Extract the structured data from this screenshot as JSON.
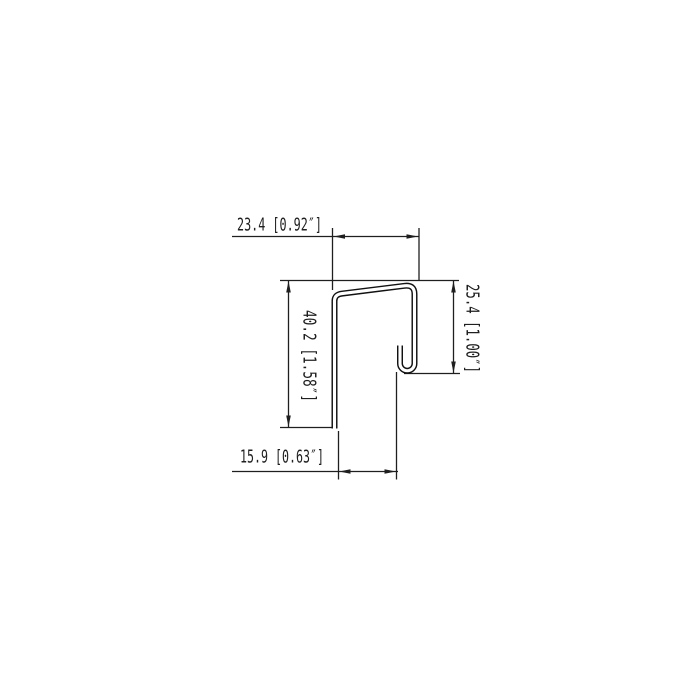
{
  "drawing": {
    "type": "technical-profile-cross-section",
    "background_color": "#ffffff",
    "line_color": "#1f1f1f",
    "dimensions": {
      "top_width": {
        "label": "23.4 [0.92″]",
        "mm": 23.4,
        "inches": 0.92
      },
      "left_height": {
        "label": "40.2 [1.58″]",
        "mm": 40.2,
        "inches": 1.58
      },
      "right_height": {
        "label": "25.4 [1.00″]",
        "mm": 25.4,
        "inches": 1.0
      },
      "bottom_width": {
        "label": "15.9 [0.63″]",
        "mm": 15.9,
        "inches": 0.63
      }
    }
  }
}
